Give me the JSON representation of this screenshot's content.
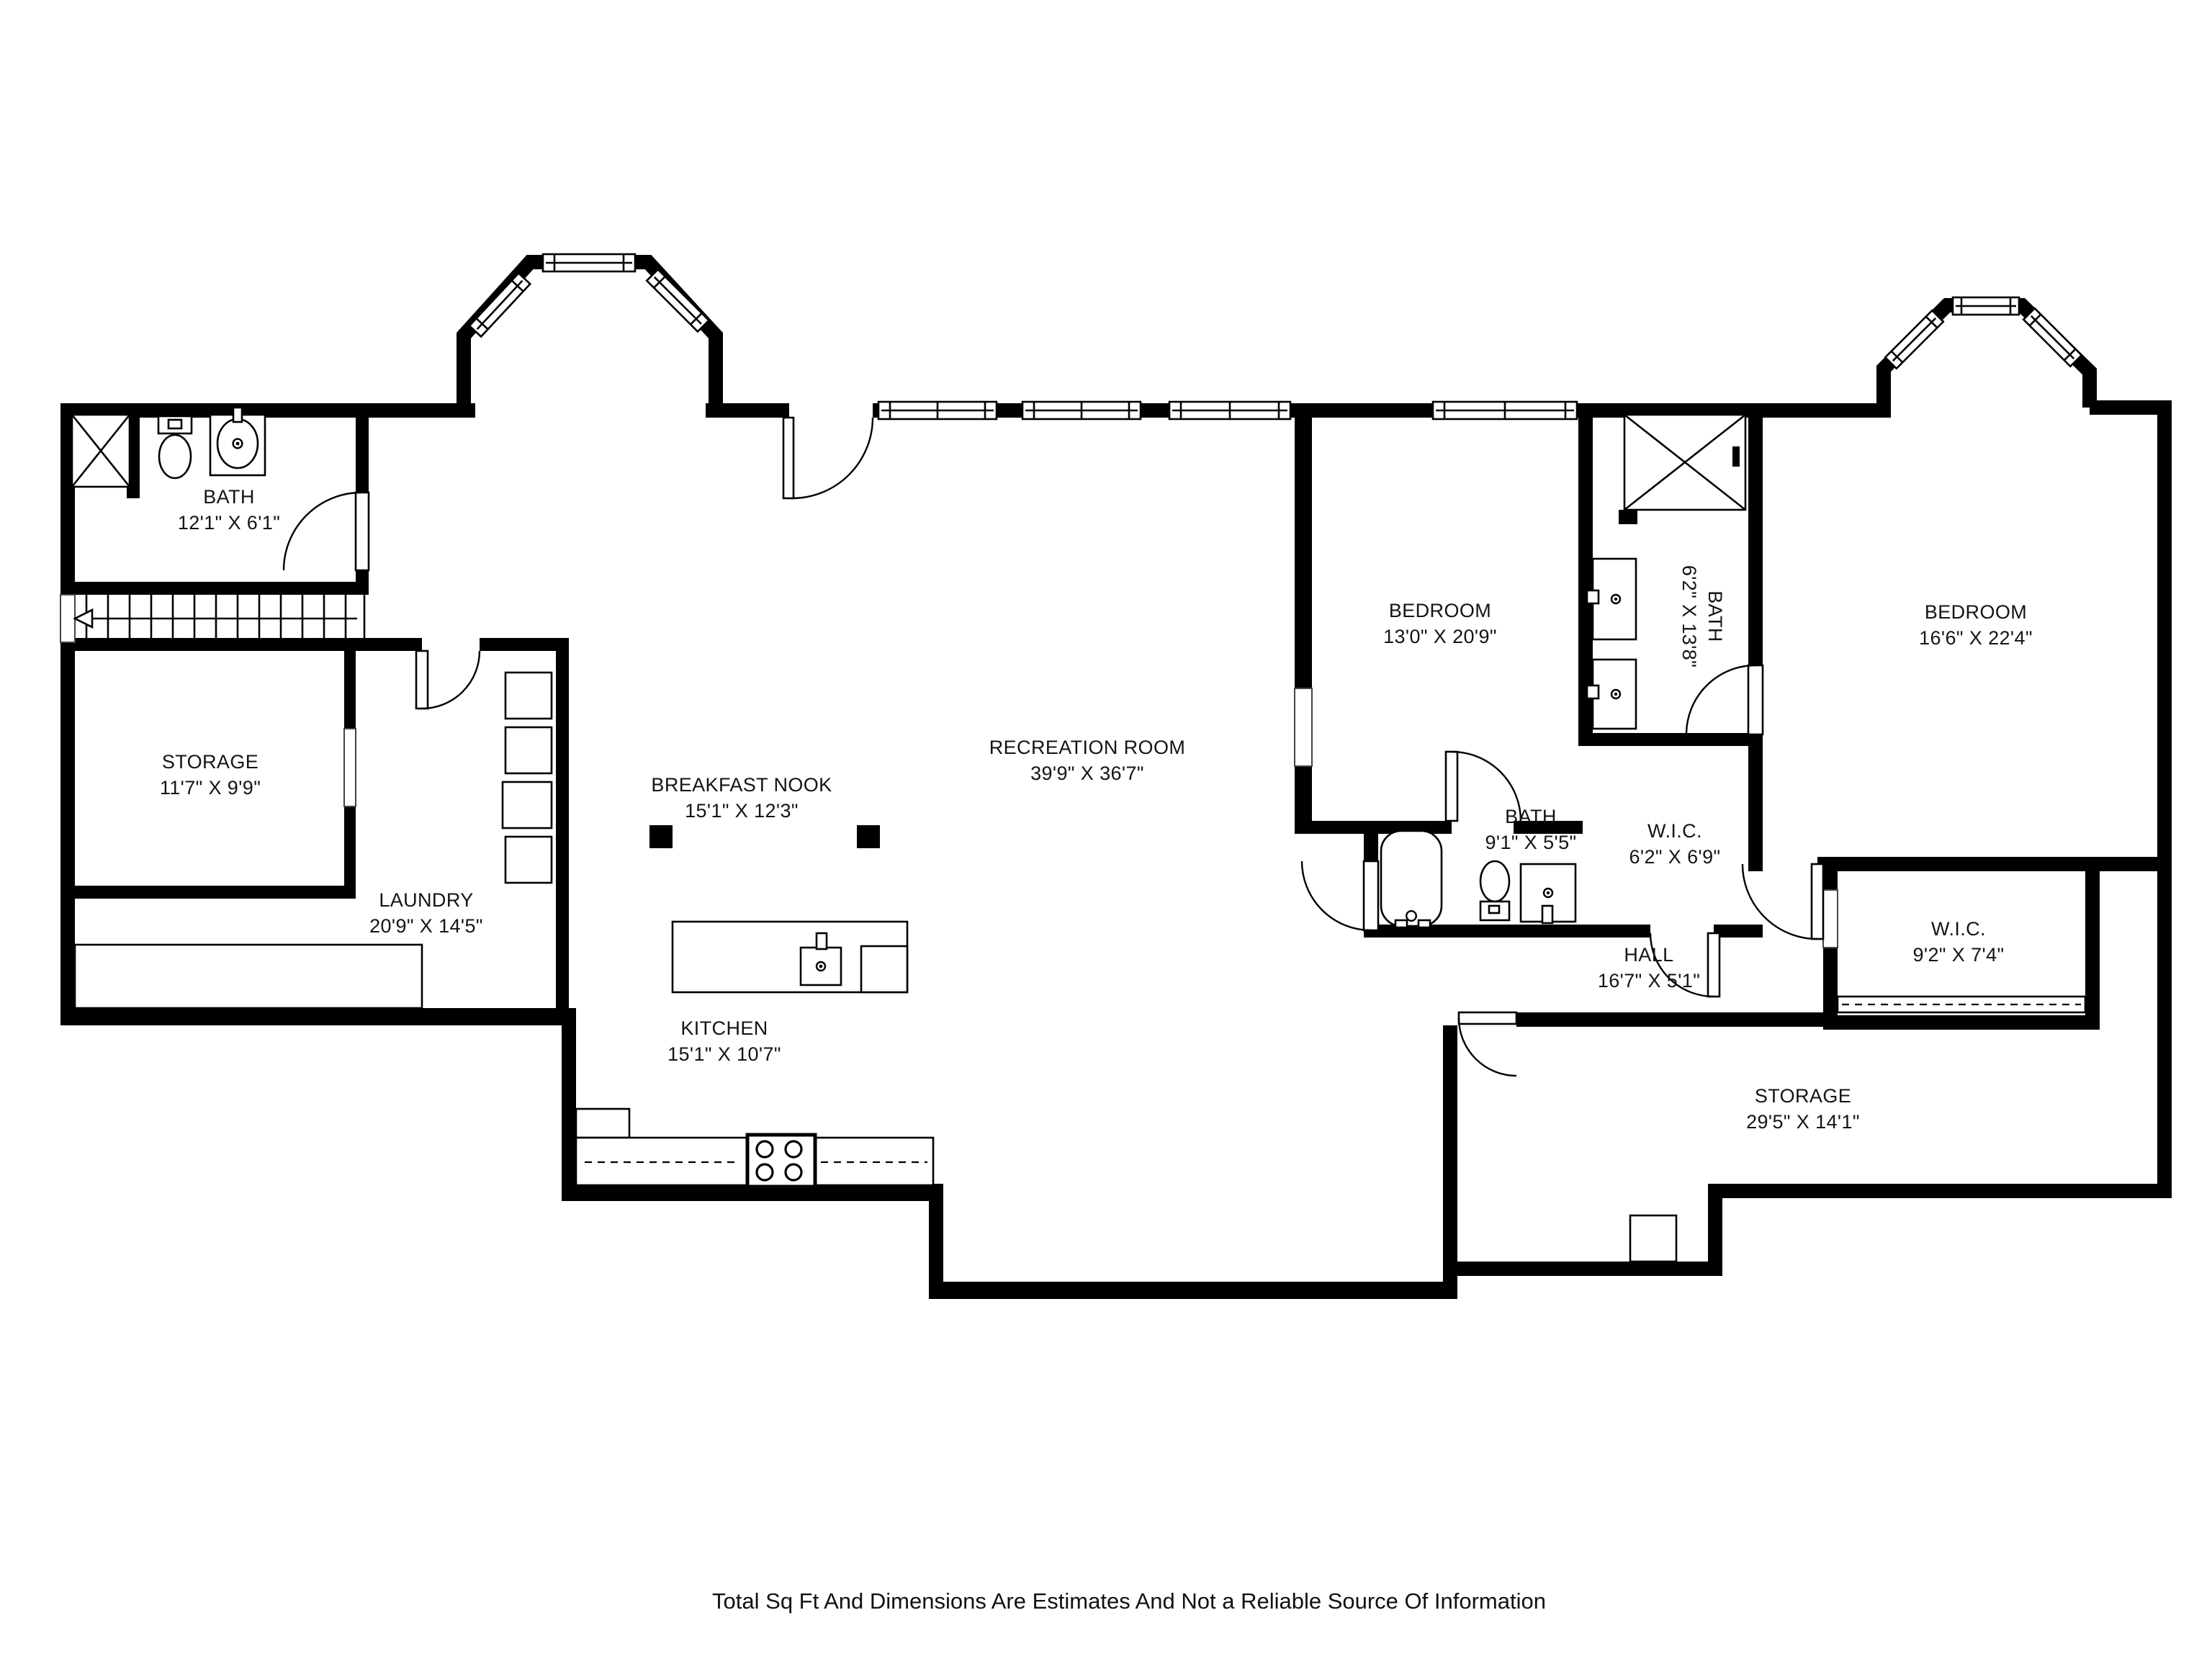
{
  "plan_type": "floor-plan",
  "colors": {
    "wall": "#000000",
    "background": "#ffffff",
    "text": "#141414"
  },
  "rooms": [
    {
      "id": "bath-top-left",
      "name": "BATH",
      "dims": "12'1\" X 6'1\"",
      "rotated": false
    },
    {
      "id": "storage-left",
      "name": "STORAGE",
      "dims": "11'7\" X 9'9\"",
      "rotated": false
    },
    {
      "id": "laundry",
      "name": "LAUNDRY",
      "dims": "20'9\" X 14'5\"",
      "rotated": false
    },
    {
      "id": "breakfast-nook",
      "name": "BREAKFAST NOOK",
      "dims": "15'1\" X 12'3\"",
      "rotated": false
    },
    {
      "id": "recreation-room",
      "name": "RECREATION ROOM",
      "dims": "39'9\" X 36'7\"",
      "rotated": false
    },
    {
      "id": "kitchen",
      "name": "KITCHEN",
      "dims": "15'1\" X 10'7\"",
      "rotated": false
    },
    {
      "id": "bedroom-1",
      "name": "BEDROOM",
      "dims": "13'0\" X 20'9\"",
      "rotated": false
    },
    {
      "id": "bath-vertical",
      "name": "BATH",
      "dims": "6'2\" X 13'8\"",
      "rotated": true
    },
    {
      "id": "bedroom-2",
      "name": "BEDROOM",
      "dims": "16'6\" X 22'4\"",
      "rotated": false
    },
    {
      "id": "bath-2",
      "name": "BATH",
      "dims": "9'1\" X 5'5\"",
      "rotated": false
    },
    {
      "id": "wic-small",
      "name": "W.I.C.",
      "dims": "6'2\" X 6'9\"",
      "rotated": false
    },
    {
      "id": "hall",
      "name": "HALL",
      "dims": "16'7\" X 5'1\"",
      "rotated": false
    },
    {
      "id": "wic-large",
      "name": "W.I.C.",
      "dims": "9'2\" X 7'4\"",
      "rotated": false
    },
    {
      "id": "storage-bottom",
      "name": "STORAGE",
      "dims": "29'5\" X 14'1\"",
      "rotated": false
    }
  ],
  "fixtures": [
    "shower-icon",
    "toilet-icon",
    "sink-icon",
    "bathtub-icon",
    "vanity-icon",
    "stairs-up-arrow",
    "washer-dryer-stack",
    "kitchen-island-sink",
    "stove-icon",
    "closet-rod",
    "support-post",
    "door-swing",
    "window",
    "bay-window"
  ],
  "disclaimer": "Total Sq Ft And Dimensions Are Estimates And Not a Reliable Source Of Information"
}
